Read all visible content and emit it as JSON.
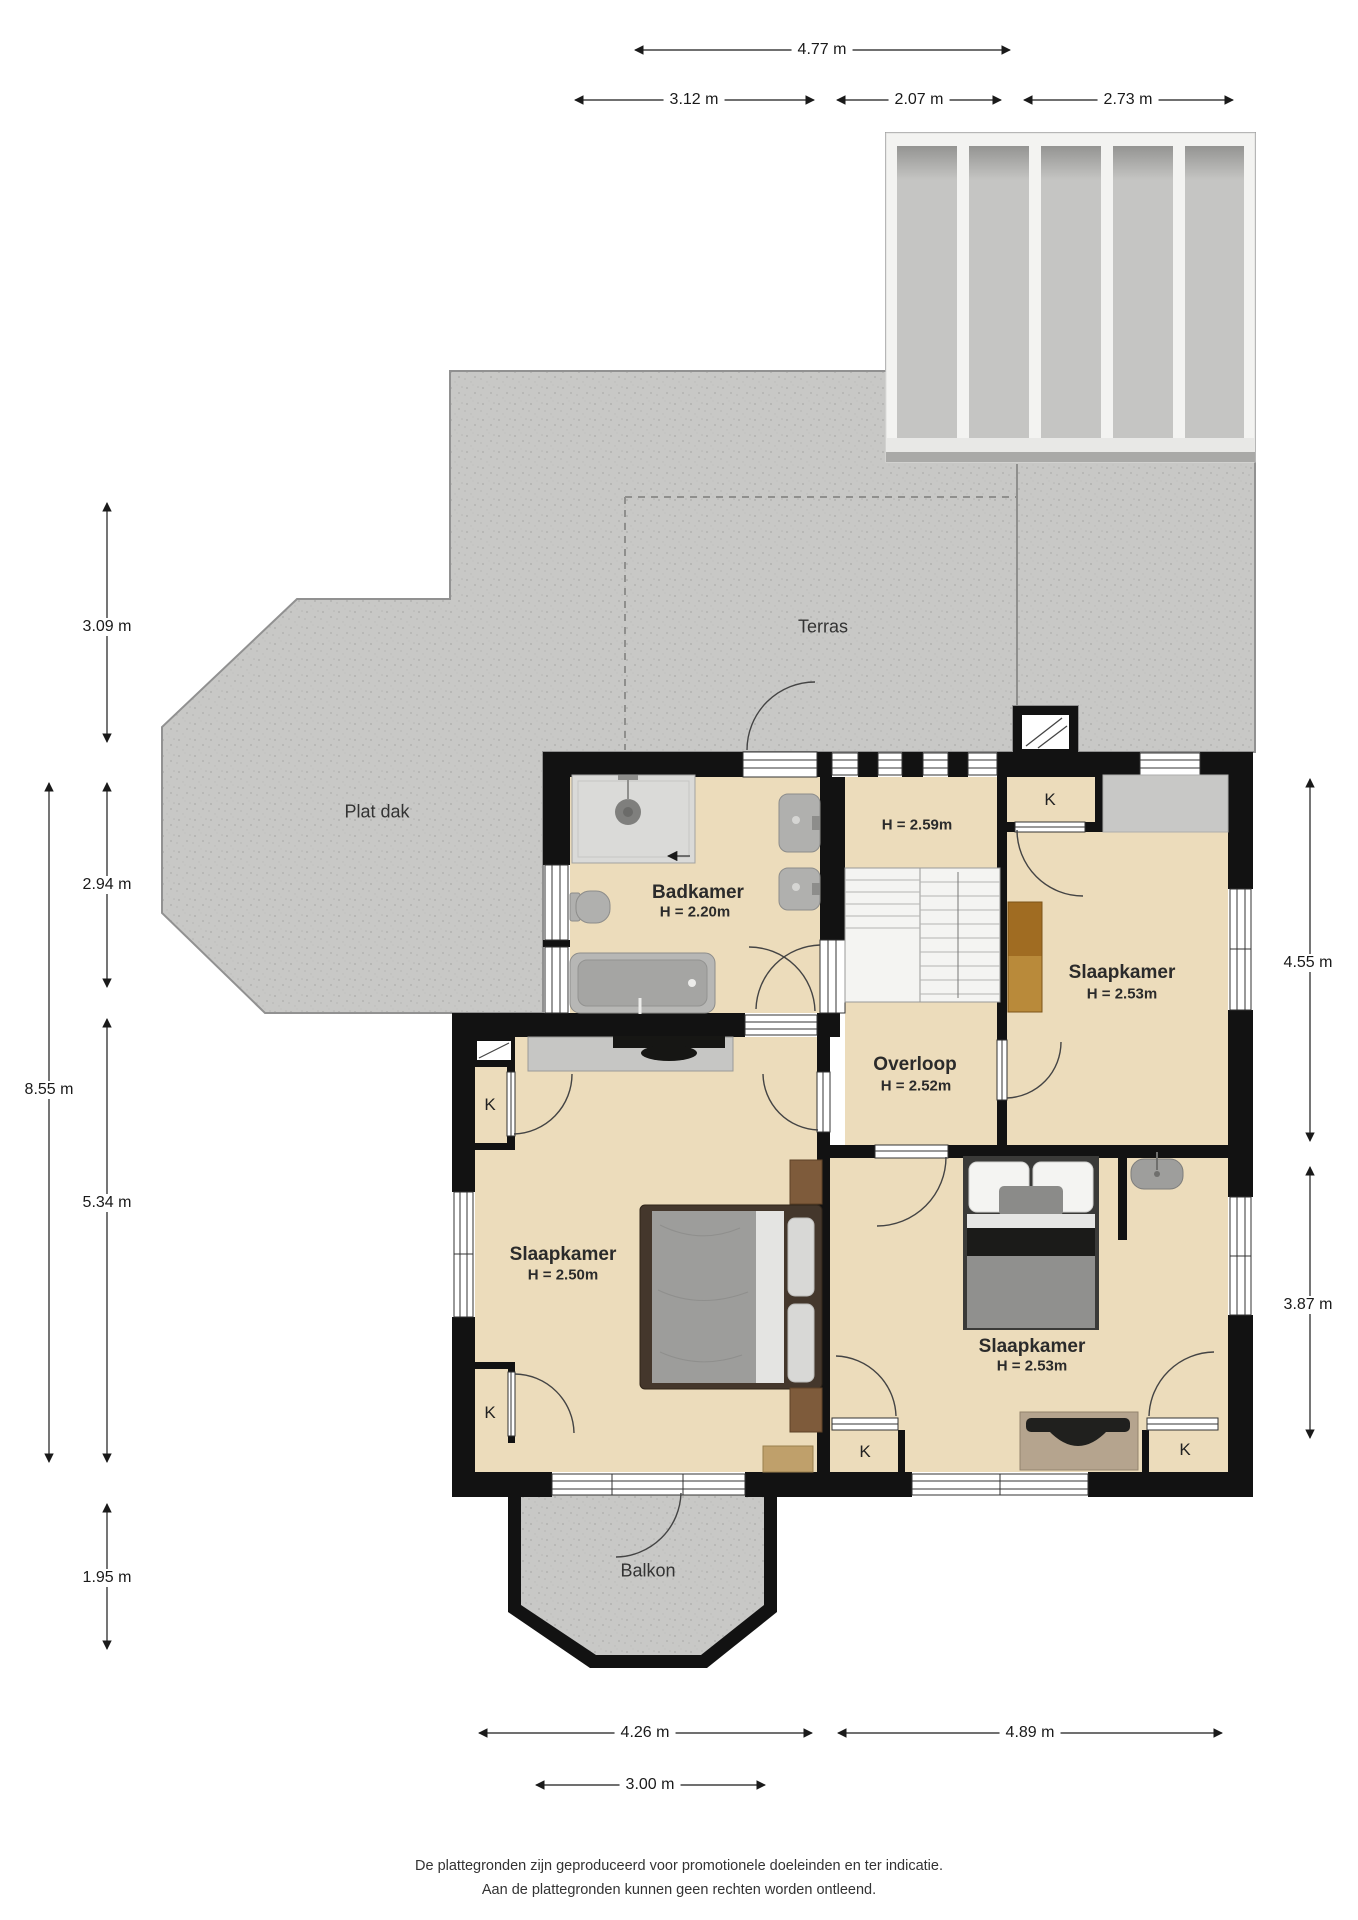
{
  "page": {
    "type": "floor-plan",
    "floor": "verdieping"
  },
  "areas": {
    "terras": "Terras",
    "plat_dak": "Plat dak",
    "balkon": "Balkon"
  },
  "rooms": {
    "badkamer": {
      "name": "Badkamer",
      "height": "H = 2.20m"
    },
    "stairwell": {
      "height": "H = 2.59m"
    },
    "overloop": {
      "name": "Overloop",
      "height": "H = 2.52m"
    },
    "slaapkamer_rechtsboven": {
      "name": "Slaapkamer",
      "height": "H = 2.53m"
    },
    "slaapkamer_links": {
      "name": "Slaapkamer",
      "height": "H = 2.50m"
    },
    "slaapkamer_rechtsonder": {
      "name": "Slaapkamer",
      "height": "H = 2.53m"
    }
  },
  "closets": {
    "label": "K"
  },
  "dimensions": {
    "top": [
      "4.77 m",
      "3.12 m",
      "2.07 m",
      "2.73 m"
    ],
    "left": [
      "3.09 m",
      "2.94 m",
      "8.55 m",
      "5.34 m",
      "1.95 m"
    ],
    "right": [
      "4.55 m",
      "3.87 m"
    ],
    "bottom": [
      "4.26 m",
      "4.89 m",
      "3.00 m"
    ]
  },
  "footer": {
    "line1": "De plattegronden zijn geproduceerd voor promotionele doeleinden en ter indicatie.",
    "line2": "Aan de plattegronden kunnen geen rechten worden ontleend."
  },
  "colors": {
    "wall": "#121212",
    "floor": "#ecdcbb",
    "concrete": "#c8c8c6",
    "skylight_pane": "#c5c5c3"
  }
}
